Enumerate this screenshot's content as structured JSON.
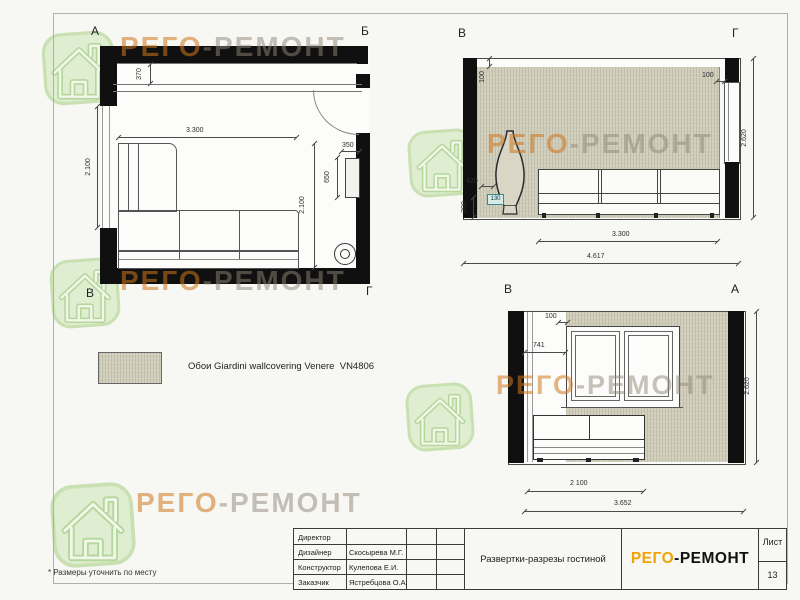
{
  "sheet": {
    "footnote": "* Размеры уточнить по месту",
    "brand": {
      "first": "РЕГО",
      "rest": "-РЕМОНТ"
    }
  },
  "legend": {
    "wallpaper_label": "Обои Giardini wallcovering Venere  VN4806"
  },
  "plan": {
    "corner_tl": "А",
    "corner_tr": "Б",
    "corner_bl": "В",
    "corner_br": "Г",
    "dim_ledge_depth": "370",
    "dim_window_width": "2.100",
    "dim_sofa_width": "3.300",
    "dim_sofa_depth": "2.100",
    "dim_console_width": "350",
    "dim_console_length": "650"
  },
  "elevation_vg": {
    "corner_left": "В",
    "corner_right": "Г",
    "dim_gap_left": "100",
    "dim_gap_right": "100",
    "dim_height": "2.620",
    "dim_vase_width": "420",
    "dim_plinth_height": "200",
    "dim_tag": "130",
    "dim_sofa_width": "3.300",
    "dim_total_width": "4.617"
  },
  "elevation_va": {
    "corner_left": "В",
    "corner_right": "А",
    "dim_gap_top": "100",
    "dim_pier_width": "741",
    "dim_height": "2.620",
    "dim_cabinet_width": "2 100",
    "dim_total_width": "3.652"
  },
  "title_block": {
    "rows": [
      {
        "label": "Директор",
        "value": ""
      },
      {
        "label": "Дизайнер",
        "value": "Скосырева М.Г."
      },
      {
        "label": "Конструктор",
        "value": "Кулепова Е.И."
      },
      {
        "label": "Заказчик",
        "value": "Ястребцова О.А."
      }
    ],
    "drawing_title": "Развертки-разрезы гостиной",
    "brand_first": "РЕГО",
    "brand_rest": "-РЕМОНТ",
    "sheet_label": "Лист",
    "sheet_number": "13"
  },
  "colors": {
    "brand_orange": "#f0a307",
    "wall_black": "#101010",
    "wallpaper_beige": "#d0cdbb",
    "watermark_green": "#d9ebc7",
    "watermark_orange": "#cd761c"
  },
  "icons": {
    "watermark": "house-icon"
  }
}
